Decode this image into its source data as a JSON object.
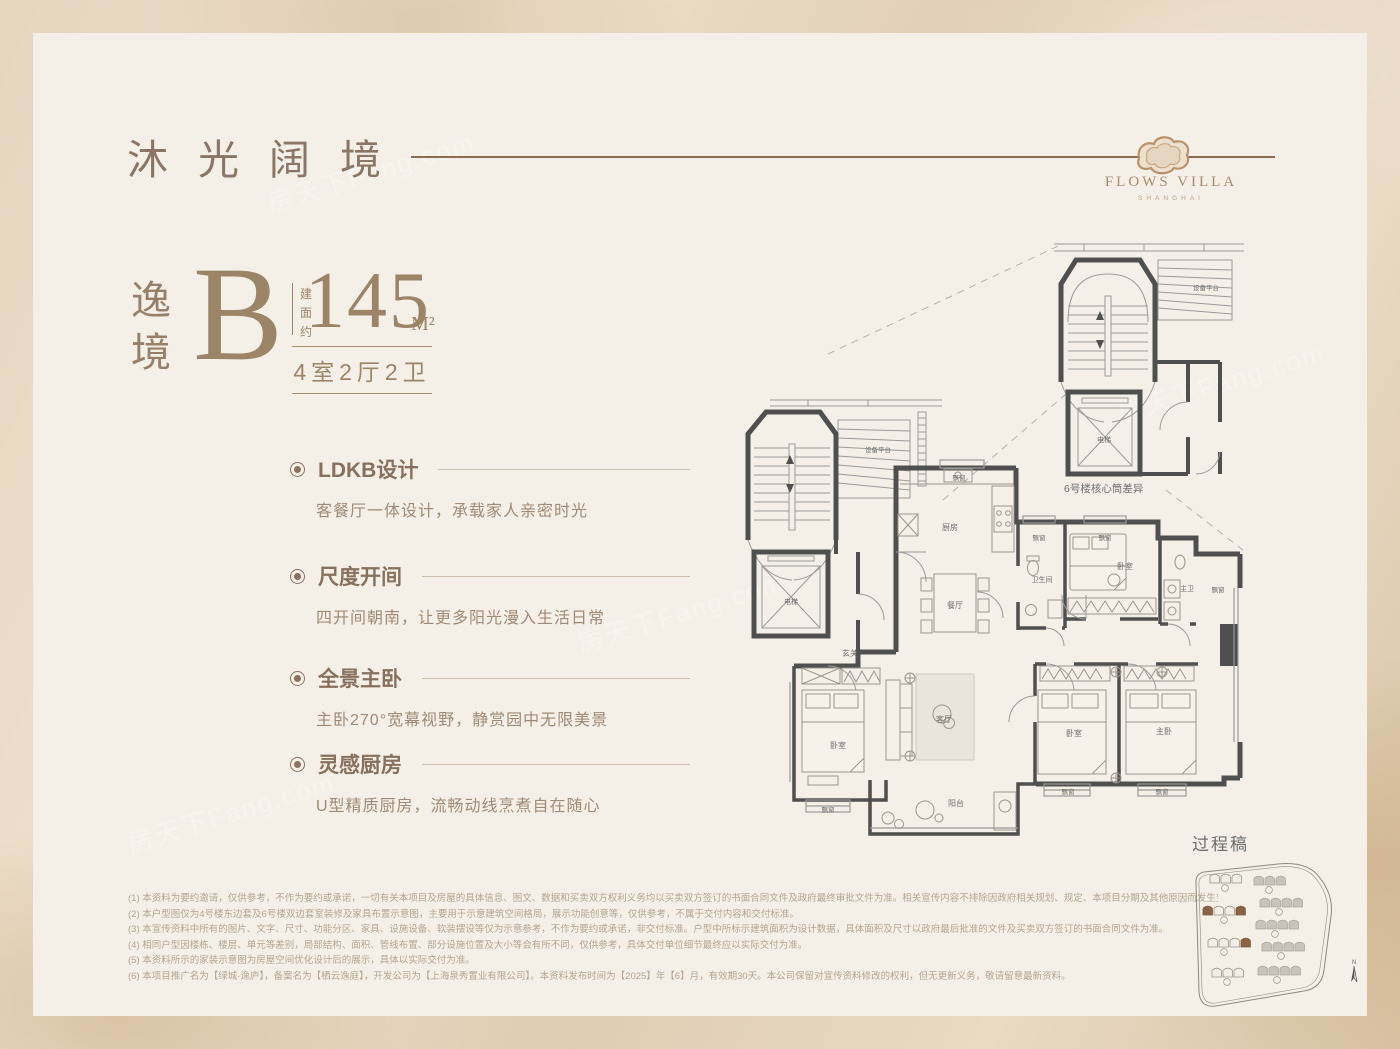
{
  "watermark": "房天下Fang.com",
  "header": {
    "title": "沐光阔境",
    "logo_name": "FLOWS VILLA",
    "logo_sub": "SHANGHAI"
  },
  "unit": {
    "name_char1": "逸",
    "name_char2": "境",
    "type_letter": "B",
    "area_label": "建面约",
    "area_value": "145",
    "area_unit": "M²",
    "rooms_summary": "4室2厅2卫"
  },
  "features": [
    {
      "title": "LDKB设计",
      "desc": "客餐厅一体设计，承载家人亲密时光"
    },
    {
      "title": "尺度开间",
      "desc": "四开间朝南，让更多阳光漫入生活日常"
    },
    {
      "title": "全景主卧",
      "desc": "主卧270°宽幕视野，静赏园中无限美景"
    },
    {
      "title": "灵感厨房",
      "desc": "U型精质厨房，流畅动线烹煮自在随心"
    }
  ],
  "floorplan": {
    "labels": {
      "kitchen": "厨房",
      "dining": "餐厅",
      "bath": "卫生间",
      "bedroom": "卧室",
      "master_bath": "主卫",
      "foyer": "玄关",
      "living": "客厅",
      "balcony": "阳台",
      "master_bedroom": "主卧",
      "bay_window": "飘窗",
      "elevator": "电梯",
      "equipment_platform": "设备平台",
      "core_note": "6号楼核心筒差异",
      "draft_note": "过程稿",
      "north": "N"
    }
  },
  "disclaimer": {
    "lines": [
      "(1) 本资料为要约邀请，仅供参考，不作为要约或承诺，一切有关本项目及房屋的具体信息、图文、数据和买卖双方权利义务均以买卖双方签订的书面合同文件及政府最终审批文件为准。相关宣传内容不排除因政府相关规划、规定、本项目分期及其他原因而发生变化。",
      "(2) 本户型图仅为4号楼东边套及6号楼双边套室装修及家具布置示意图，主要用于示意建筑空间格局，展示功能创意等，仅供参考，不属于交付内容和交付标准。",
      "(3) 本宣传资料中所有的图片、文字、尺寸、功能分区、家具、设施设备、软装摆设等仅为示意参考，不作为要约或承诺，非交付标准。户型中所标示建筑面积为设计数据，具体面积及尺寸以政府最后批准的文件及买卖双方签订的书面合同文件为准。",
      "(4) 相同户型因楼栋、楼层、单元等差别，局部结构、面积、管线布置、部分设施位置及大小等会有所不同，仅供参考，具体交付单位细节最终应以实际交付为准。",
      "(5) 本资料所示的家装示意图为房屋空间优化设计后的展示，具体以实际交付为准。",
      "(6) 本项目推广名为【绿城·逸庐】，备案名为【栖云逸庭】，开发公司为【上海泉秀置业有限公司】。本资料发布时间为【2025】年【6】月，有效期30天。本公司保留对宣传资料修改的权利，但无更新义务，敬请留意最新资料。"
    ]
  },
  "colors": {
    "accent_brown": "#9c8467",
    "header_line": "#8a6b4d",
    "wall_gray": "#4f4f4f",
    "note_brown": "#a2714e",
    "panel_bg": "#f4f0e7"
  }
}
